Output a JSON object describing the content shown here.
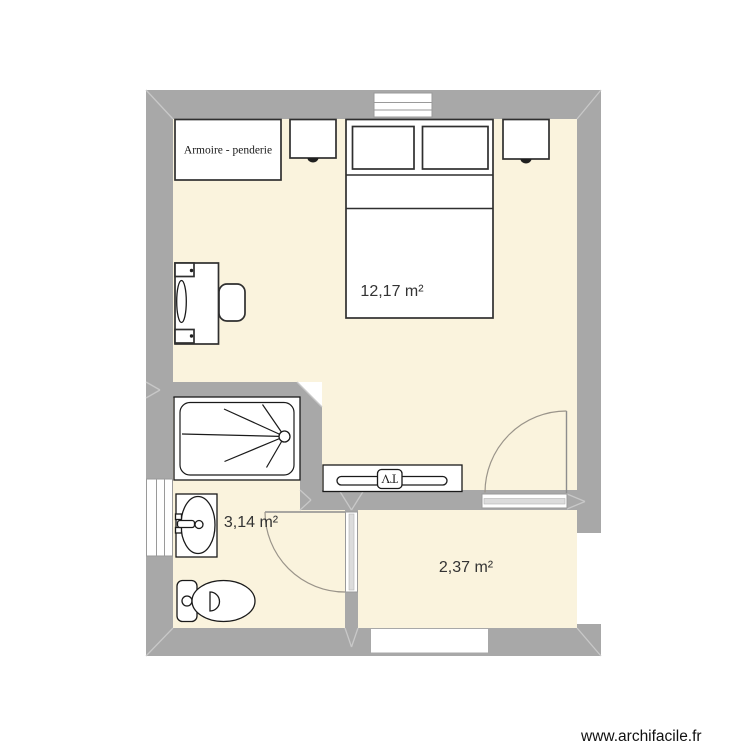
{
  "plan": {
    "watermark": "www.archifacile.fr",
    "rooms": [
      {
        "id": "bedroom",
        "area_label": "12,17 m²"
      },
      {
        "id": "bathroom",
        "area_label": "3,14 m²"
      },
      {
        "id": "entry-room",
        "area_label": "2,37 m²"
      }
    ],
    "furniture_labels": {
      "wardrobe": "Armoire - penderie",
      "tv": "TV"
    },
    "colors": {
      "wall": "#a8a8a8",
      "floor": "#faf3dd",
      "furniture_stroke": "#2f2f2f",
      "fixture_stroke": "#1a1a1a",
      "door_arc": "#9a948a",
      "miter_line": "#c8c8c8",
      "label_text": "#333333",
      "watermark_text": "#111111"
    }
  }
}
